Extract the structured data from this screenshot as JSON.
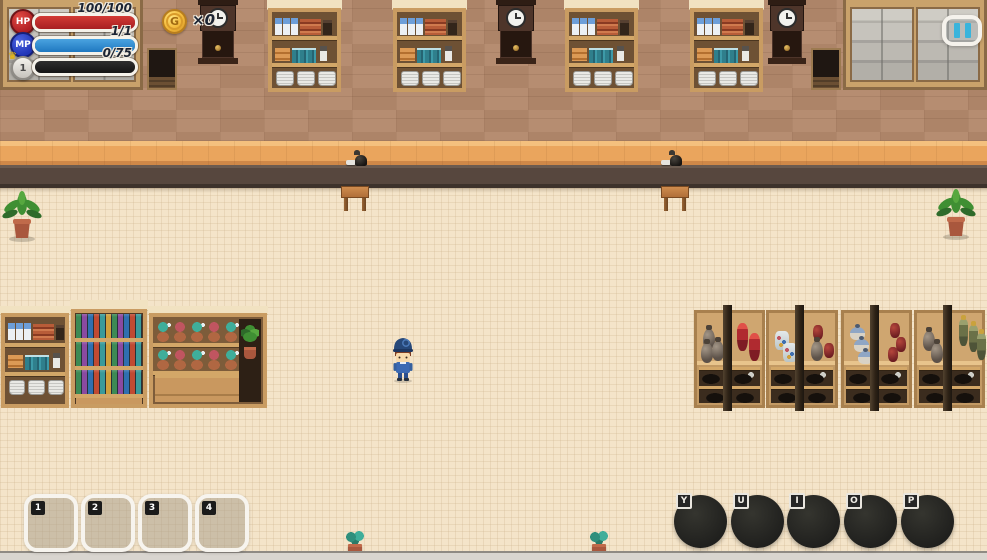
{
  "hud": {
    "stats": [
      {
        "label": "HP",
        "value": "100/100"
      },
      {
        "label": "MP",
        "value": "1/1"
      },
      {
        "label": "1",
        "value": "0/75"
      }
    ],
    "currency": {
      "symbol": "G",
      "count": "×0"
    },
    "hotbar": [
      {
        "key": "1"
      },
      {
        "key": "2"
      },
      {
        "key": "3"
      },
      {
        "key": "4"
      }
    ],
    "actions": [
      {
        "key": "Y"
      },
      {
        "key": "U"
      },
      {
        "key": "I"
      },
      {
        "key": "O"
      },
      {
        "key": "P"
      }
    ]
  },
  "icons": {
    "crown": "♛",
    "coin": "gold-coin",
    "pause": "pause-bars"
  },
  "colors": {
    "hp_bar": "#b8262a",
    "mp_bar": "#2f8fd6",
    "xp_bar": "#1f1f1f",
    "coin_gold": "#f3b93a",
    "pause_cyan": "#39b4dc",
    "wall": "#b3886b",
    "floor": "#f4e4c9",
    "counter_top": "#eaa55d",
    "counter_front": "#57473e"
  }
}
